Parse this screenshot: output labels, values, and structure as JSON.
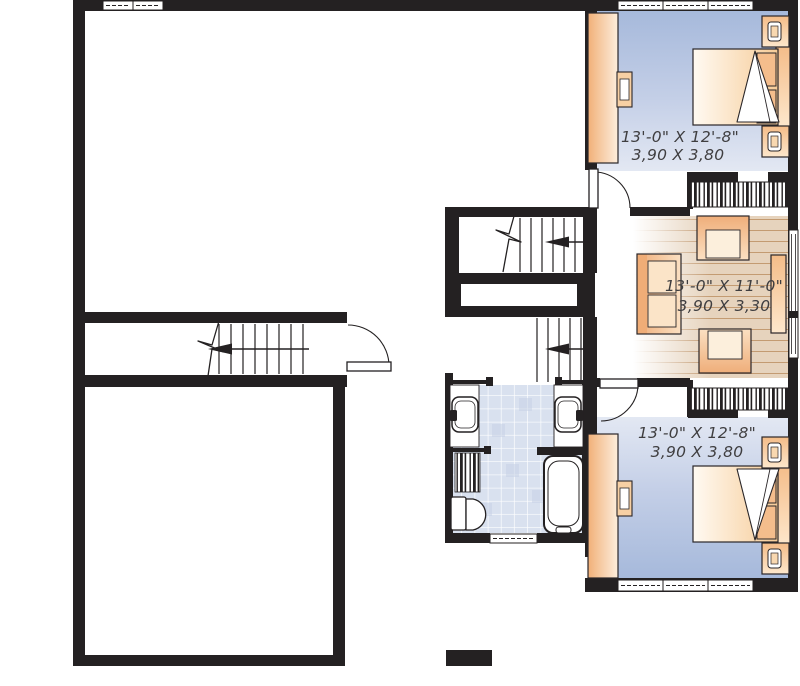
{
  "plan": {
    "bedroom_top": {
      "imperial": "13'-0\" X 12'-8\"",
      "metric": "3,90 X 3,80"
    },
    "family_room": {
      "imperial": "13'-0\" X 11'-0\"",
      "metric": "3,90 X 3,30"
    },
    "bedroom_bottom": {
      "imperial": "13'-0\" X 12'-8\"",
      "metric": "3,90 X 3,80"
    }
  },
  "colors": {
    "wall": "#242122",
    "bedroom_floor": "#a6b9db",
    "wood_floor": "#e6d3bd",
    "wood_plank_line": "#c39b72",
    "tile_floor": "#d9e1ef",
    "furniture_orange": "#f4bd8c",
    "label_text": "#3f3e40"
  }
}
